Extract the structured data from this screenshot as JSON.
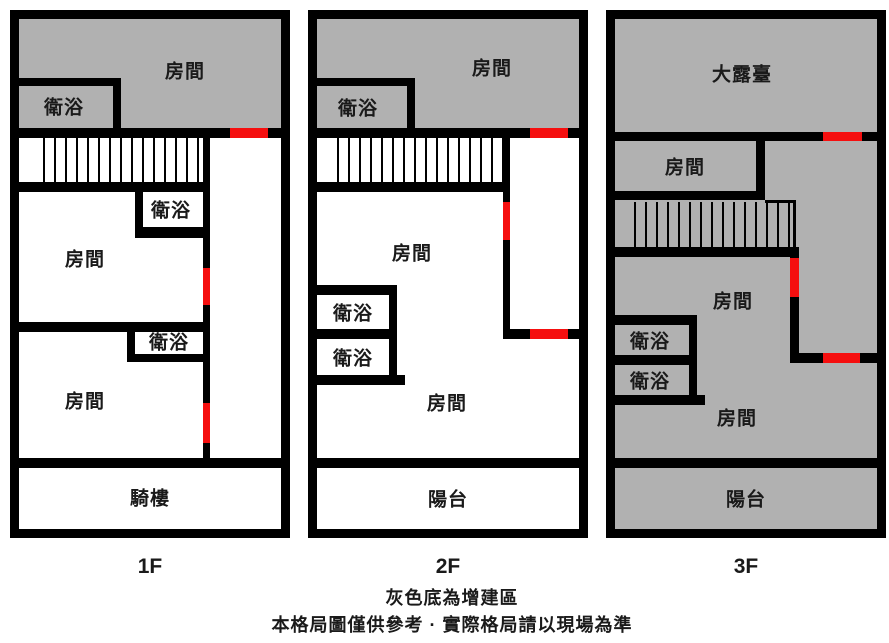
{
  "colors": {
    "wall": "#000000",
    "extension_fill": "#b1b1b1",
    "door_marker": "#f50f0f",
    "background": "#ffffff"
  },
  "floors": [
    {
      "label": "1F",
      "rooms": {
        "bedroom_top": "房間",
        "bath_top": "衛浴",
        "bath_mid": "衛浴",
        "bedroom_mid": "房間",
        "bath_low": "衛浴",
        "bedroom_low": "房間",
        "arcade": "騎樓"
      }
    },
    {
      "label": "2F",
      "rooms": {
        "bedroom_top": "房間",
        "bath_top": "衛浴",
        "bedroom_mid": "房間",
        "bath_mid1": "衛浴",
        "bath_mid2": "衛浴",
        "bedroom_low": "房間",
        "balcony": "陽台"
      }
    },
    {
      "label": "3F",
      "rooms": {
        "terrace": "大露臺",
        "bedroom_top": "房間",
        "bedroom_mid": "房間",
        "bath_mid1": "衛浴",
        "bath_mid2": "衛浴",
        "bedroom_low": "房間",
        "balcony": "陽台"
      }
    }
  ],
  "legend": {
    "line1": "灰色底為增建區",
    "line2": "本格局圖僅供參考 · 實際格局請以現場為準"
  }
}
